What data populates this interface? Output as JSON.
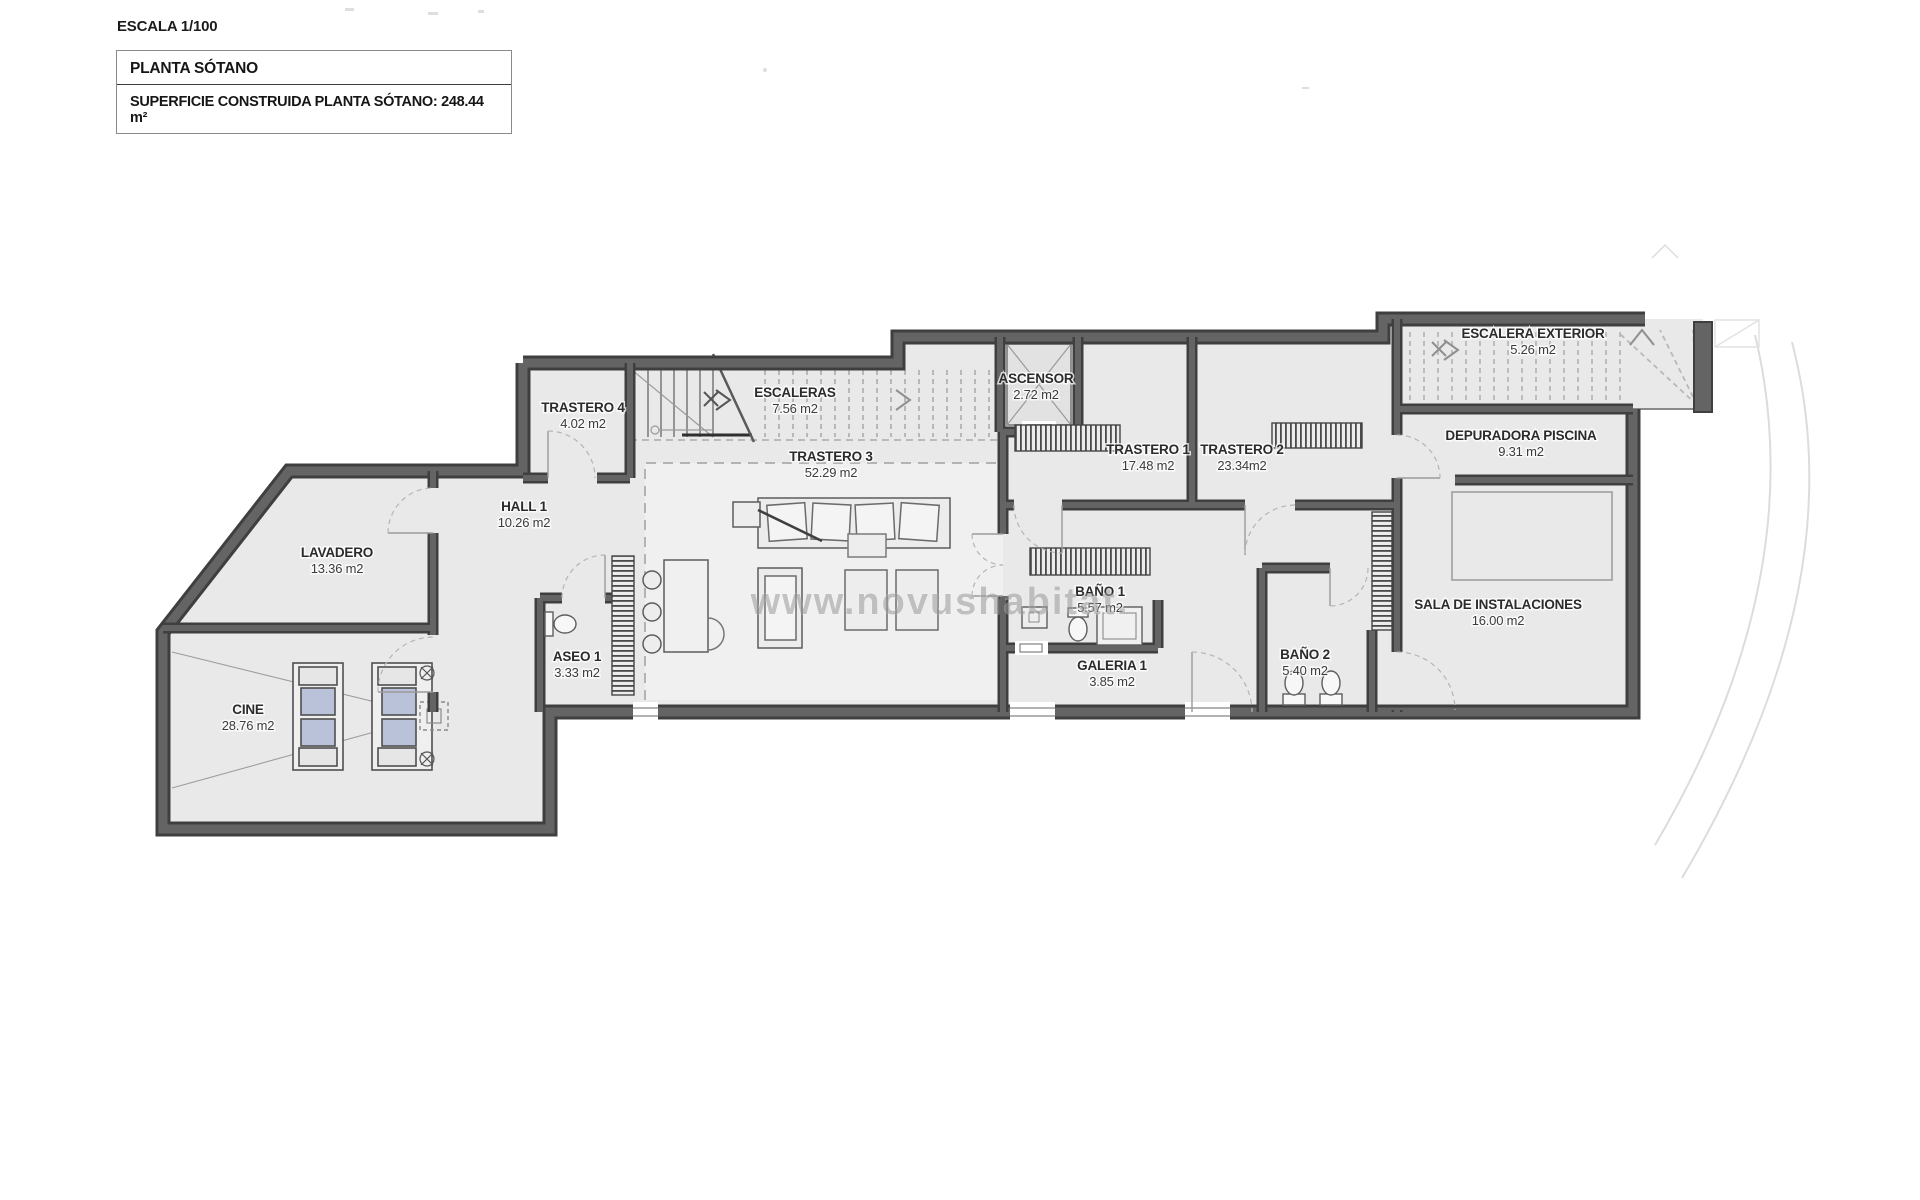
{
  "scale_label": "ESCALA 1/100",
  "title_block": {
    "title": "PLANTA SÓTANO",
    "surface_text": "SUPERFICIE CONSTRUIDA PLANTA SÓTANO: 248.44 m²"
  },
  "watermark": "www.novushabitat.",
  "colors": {
    "wall_dark": "#3f3f3f",
    "wall_gray": "#646464",
    "floor": "#e9e9e9",
    "floor_light": "#f0f0f0",
    "cushion": "#b9c2d8",
    "label": "#2b2b2b",
    "watermark": "#9a9a9a",
    "dashed": "#b3b3b3"
  },
  "rooms": [
    {
      "id": "trastero4",
      "name": "TRASTERO 4",
      "area": "4.02 m2",
      "x": 583,
      "y": 412
    },
    {
      "id": "escaleras",
      "name": "ESCALERAS",
      "area": "7.56 m2",
      "x": 795,
      "y": 397
    },
    {
      "id": "trastero3",
      "name": "TRASTERO 3",
      "area": "52.29 m2",
      "x": 831,
      "y": 461
    },
    {
      "id": "ascensor",
      "name": "ASCENSOR",
      "area": "2.72 m2",
      "x": 1036,
      "y": 383
    },
    {
      "id": "trastero1",
      "name": "TRASTERO 1",
      "area": "17.48 m2",
      "x": 1148,
      "y": 454
    },
    {
      "id": "trastero2",
      "name": "TRASTERO 2",
      "area": "23.34m2",
      "x": 1242,
      "y": 454
    },
    {
      "id": "escalera-exterior",
      "name": "ESCALERA EXTERIOR",
      "area": "5.26 m2",
      "x": 1533,
      "y": 338
    },
    {
      "id": "depuradora-piscina",
      "name": "DEPURADORA PISCINA",
      "area": "9.31 m2",
      "x": 1521,
      "y": 440
    },
    {
      "id": "hall1",
      "name": "HALL 1",
      "area": "10.26 m2",
      "x": 524,
      "y": 511
    },
    {
      "id": "lavadero",
      "name": "LAVADERO",
      "area": "13.36 m2",
      "x": 337,
      "y": 557
    },
    {
      "id": "aseo1",
      "name": "ASEO 1",
      "area": "3.33 m2",
      "x": 577,
      "y": 661
    },
    {
      "id": "bano1",
      "name": "BAÑO 1",
      "area": "5.57 m2",
      "x": 1100,
      "y": 596
    },
    {
      "id": "bano2",
      "name": "BAÑO 2",
      "area": "5.40 m2",
      "x": 1305,
      "y": 659
    },
    {
      "id": "galeria1",
      "name": "GALERIA 1",
      "area": "3.85 m2",
      "x": 1112,
      "y": 670
    },
    {
      "id": "sala-instalaciones",
      "name": "SALA DE INSTALACIONES",
      "area": "16.00 m2",
      "x": 1498,
      "y": 609
    },
    {
      "id": "cine",
      "name": "CINE",
      "area": "28.76 m2",
      "x": 248,
      "y": 714
    }
  ]
}
